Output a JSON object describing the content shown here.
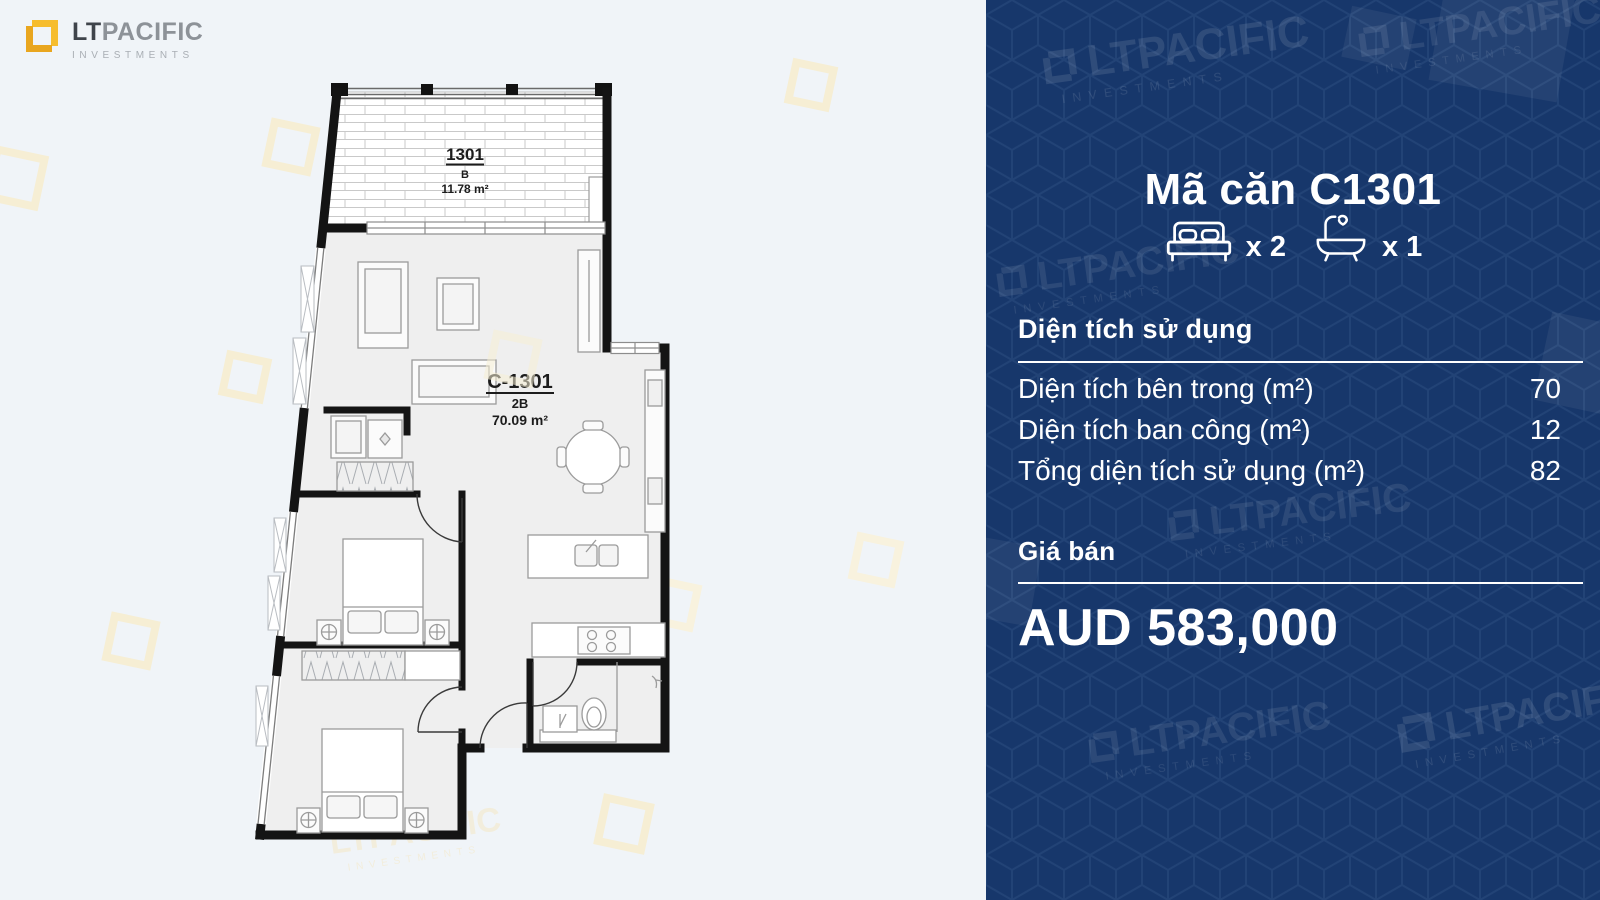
{
  "logo": {
    "lt": "LT",
    "pacific": "PACIFIC",
    "investments": "INVESTMENTS"
  },
  "watermark": {
    "brand": "LTPACIFIC",
    "sub": "INVESTMENTS"
  },
  "floorplan": {
    "balcony": {
      "unit": "1301",
      "type": "B",
      "area": "11.78 m²"
    },
    "main": {
      "unit": "C-1301",
      "type": "2B",
      "area": "70.09 m²"
    }
  },
  "panel": {
    "title": "Mã căn C1301",
    "bedrooms_count": "x 2",
    "bathrooms_count": "x 1",
    "area_section": {
      "heading": "Diện tích sử dụng",
      "rows": [
        {
          "label": "Diện tích bên trong (m²)",
          "value": "70"
        },
        {
          "label": "Diện tích ban công (m²)",
          "value": "12"
        },
        {
          "label": "Tổng diện tích sử dụng (m²)",
          "value": "82"
        }
      ]
    },
    "price_section": {
      "heading": "Giá bán",
      "price": "AUD 583,000"
    }
  },
  "colors": {
    "navy": "#17376b",
    "gold": "#f2b52b",
    "page_bg": "#f0f4f8"
  }
}
